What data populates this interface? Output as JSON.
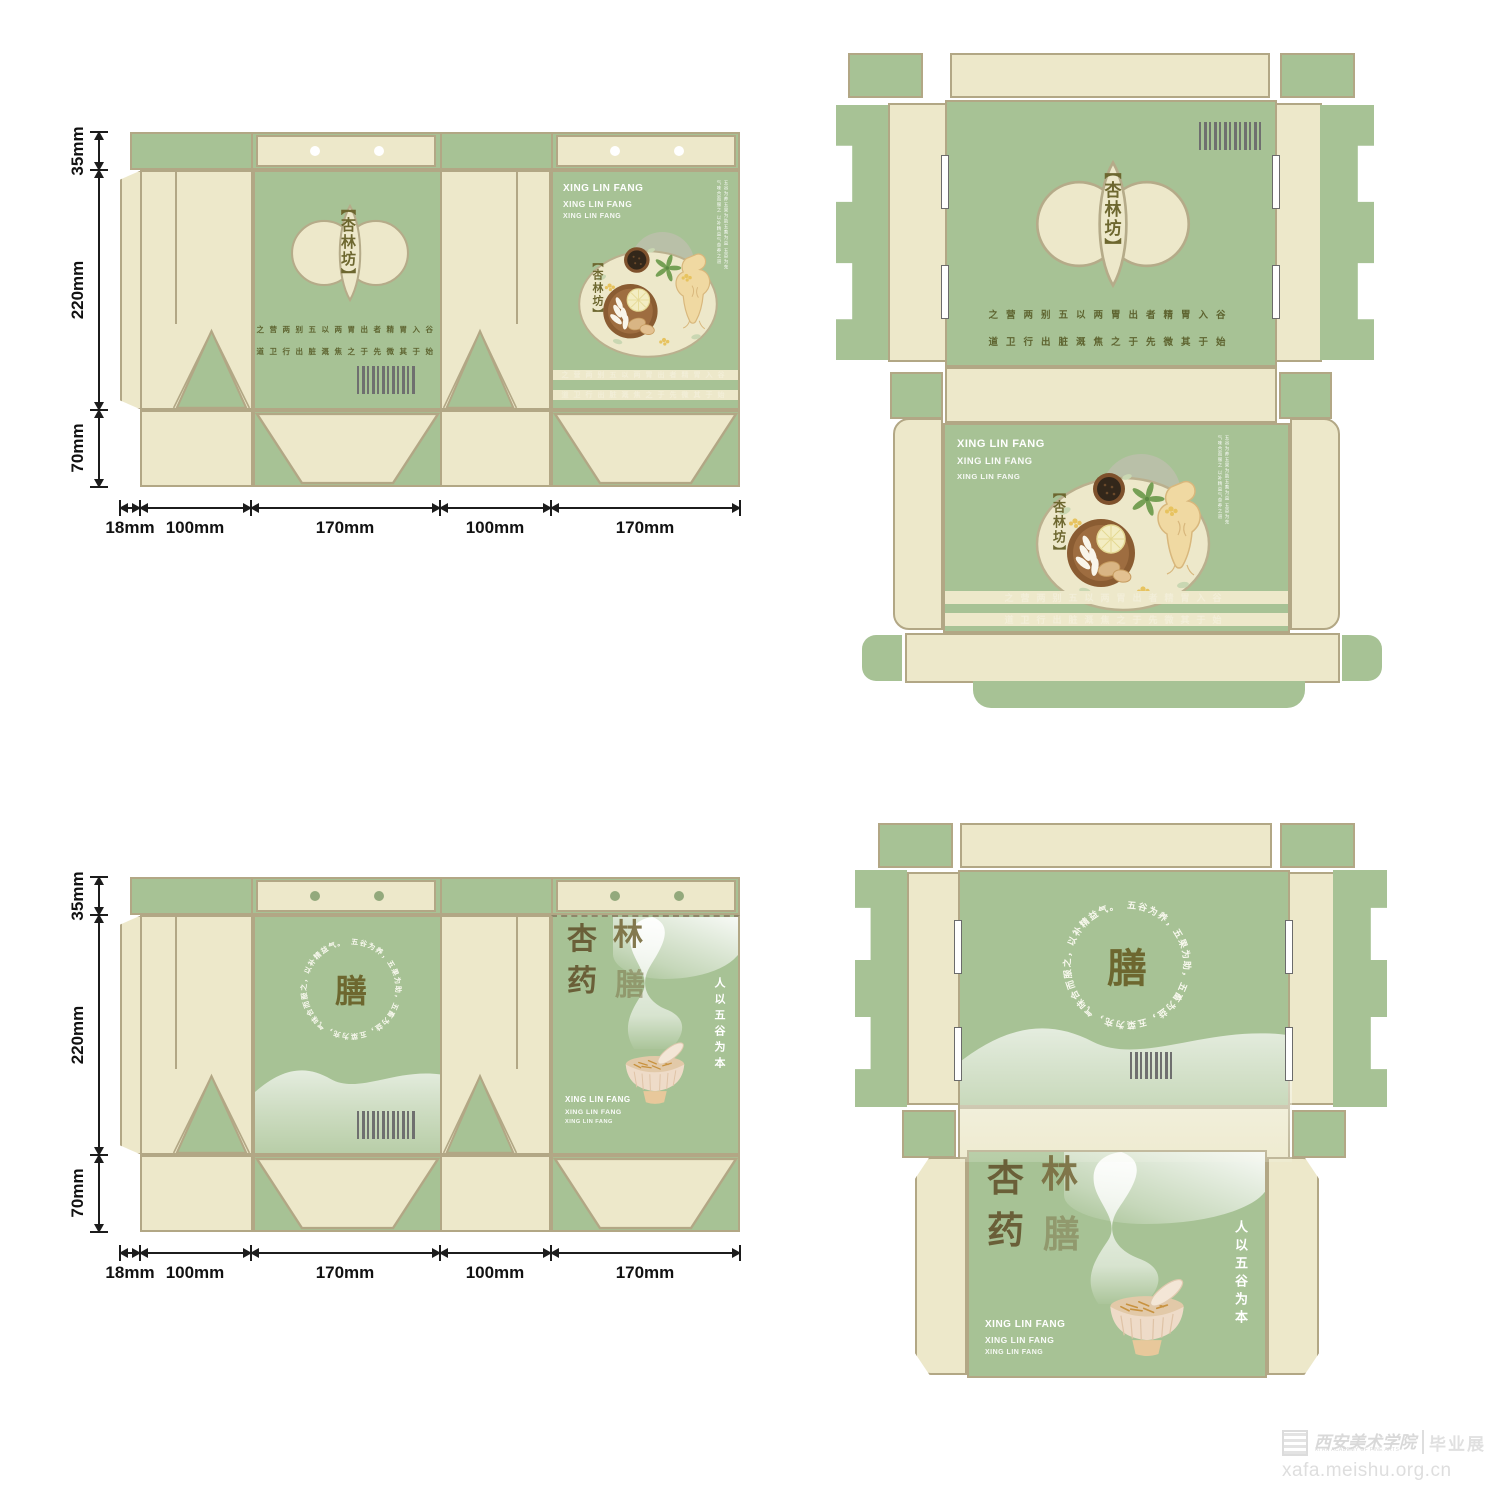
{
  "brand": {
    "logo_text": "【杏林坊】",
    "latin_lines": [
      "XING LIN FANG",
      "XING LIN FANG",
      "XING LIN FANG"
    ],
    "motto_row1": "之营两别五以两胃出者精胃入谷",
    "motto_row2": "道卫行出脏溉焦之于先微其于始",
    "ring_text": "五谷为养，五果为助，五畜为益，五菜为充，气味合而服之，以补精益气。",
    "shan_char": "膳",
    "name_c1": "杏",
    "name_c2": "林",
    "name_c3": "药",
    "name_c4": "膳",
    "slogan_vertical": "人以五谷为本",
    "side_note": "五谷为养五果为助五畜为益 五菜为充气味合而服之 以补精益气食养之道"
  },
  "dimensions": {
    "v": [
      "35mm",
      "220mm",
      "70mm"
    ],
    "h": [
      "18mm",
      "100mm",
      "170mm",
      "100mm",
      "170mm"
    ]
  },
  "colors": {
    "panel_green": "#a7c295",
    "panel_cream": "#ede8ca",
    "outline_tan": "#b2a785",
    "logo_olive": "#6d672f",
    "char_brown": "#6a5f38"
  },
  "watermark": {
    "org_cn": "西安美术学院",
    "org_en": "XI'AN ACADEMY OF FINE ARTS",
    "exhibit": "毕业展",
    "url": "xafa.meishu.org.cn"
  }
}
